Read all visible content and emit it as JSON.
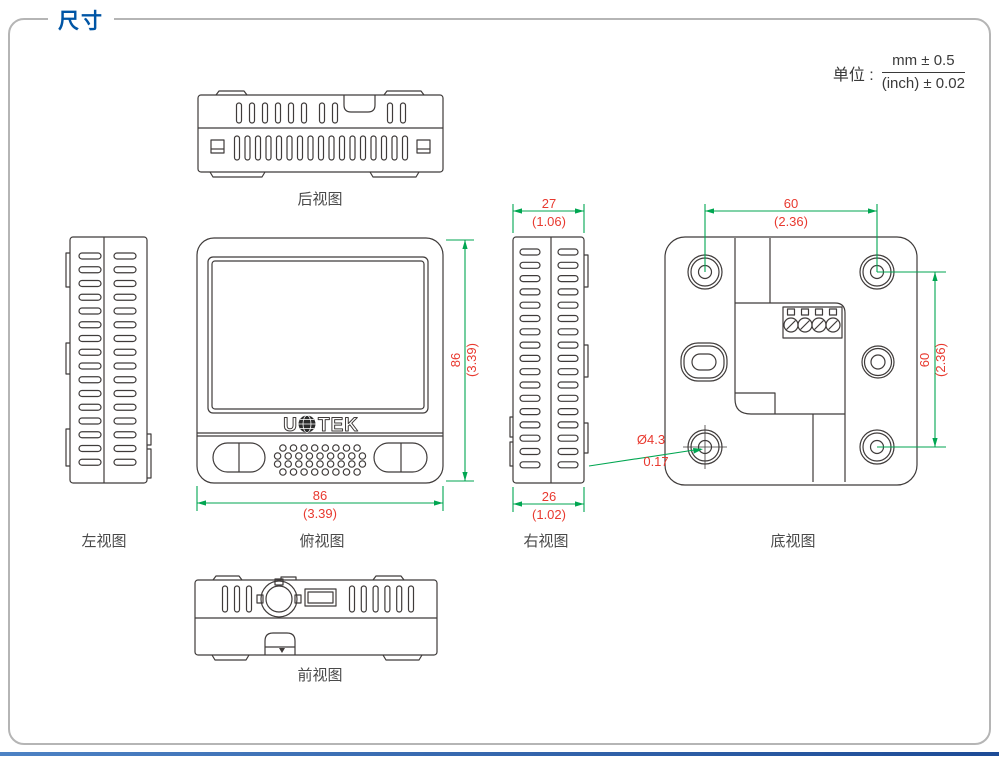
{
  "page": {
    "title": "尺寸",
    "units": {
      "label": "单位 :",
      "numerator": "mm ± 0.5",
      "denominator": "(inch) ± 0.02"
    }
  },
  "views": {
    "rear": {
      "label": "后视图"
    },
    "left": {
      "label": "左视图"
    },
    "top": {
      "label": "俯视图",
      "logo": {
        "left": "U",
        "right": "TEK"
      },
      "dims": {
        "height_mm": "86",
        "height_inch": "(3.39)",
        "width_mm": "86",
        "width_inch": "(3.39)"
      }
    },
    "right": {
      "label": "右视图",
      "dims": {
        "top_mm": "27",
        "top_inch": "(1.06)",
        "bottom_mm": "26",
        "bottom_inch": "(1.02)"
      }
    },
    "bottom": {
      "label": "底视图",
      "dims": {
        "hole_spacing_h_mm": "60",
        "hole_spacing_h_inch": "(2.36)",
        "hole_spacing_v_mm": "60",
        "hole_spacing_v_inch": "(2.36)",
        "hole_dia_mm": "Ø4.3",
        "hole_dia_inch": "0.17"
      }
    },
    "front": {
      "label": "前视图"
    }
  },
  "colors": {
    "accent_blue": "#0055A5",
    "dimension_line_green": "#00A651",
    "dimension_text_red": "#E8392F",
    "drawing_line": "#3F3B3A",
    "frame_border": "#B5B5B5",
    "footer_bar_start": "#4D82C4",
    "footer_bar_end": "#1D4B96"
  }
}
